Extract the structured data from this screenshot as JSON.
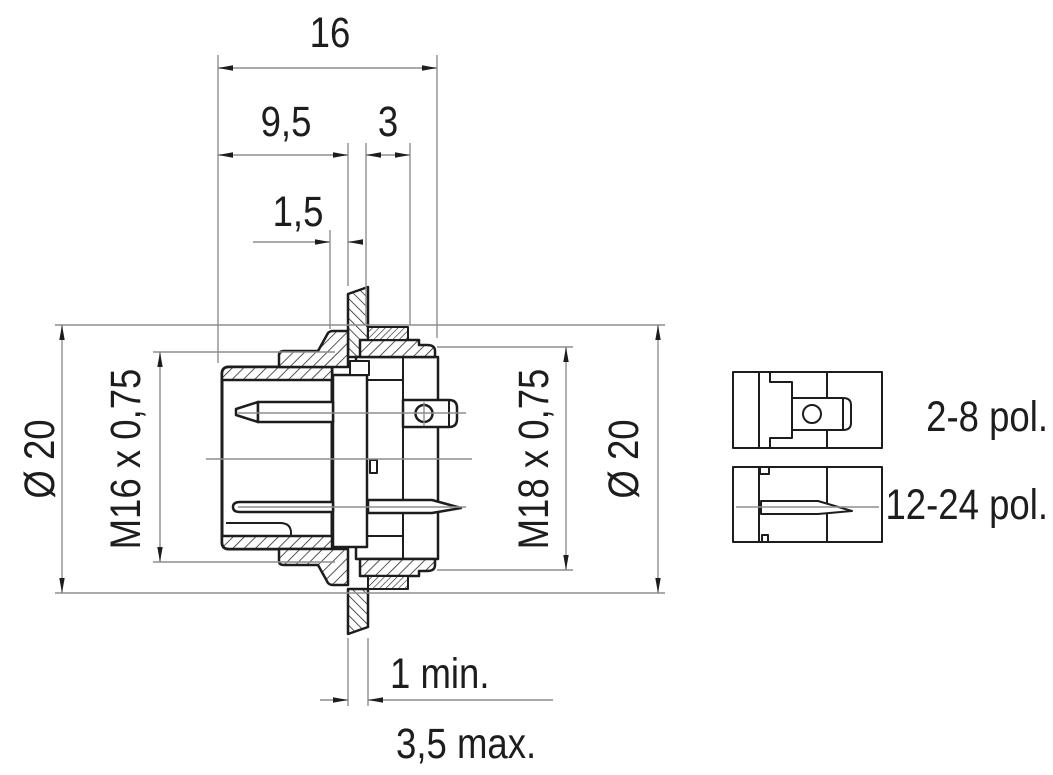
{
  "dimensions": {
    "overall_length": "16",
    "front_length": "9,5",
    "nut_width": "3",
    "shoulder_gap": "1,5",
    "diameter_left": "Ø 20",
    "thread_front": "M16 x 0,75",
    "thread_rear": "M18 x 0,75",
    "diameter_right": "Ø 20",
    "panel_thickness_min": "1 min.",
    "panel_thickness_max": "3,5 max."
  },
  "variants": [
    {
      "label": "2-8 pol."
    },
    {
      "label": "12-24 pol."
    }
  ],
  "colors": {
    "line": "#1d1d1d",
    "dim_line": "#8e8e8e",
    "background": "#ffffff"
  }
}
